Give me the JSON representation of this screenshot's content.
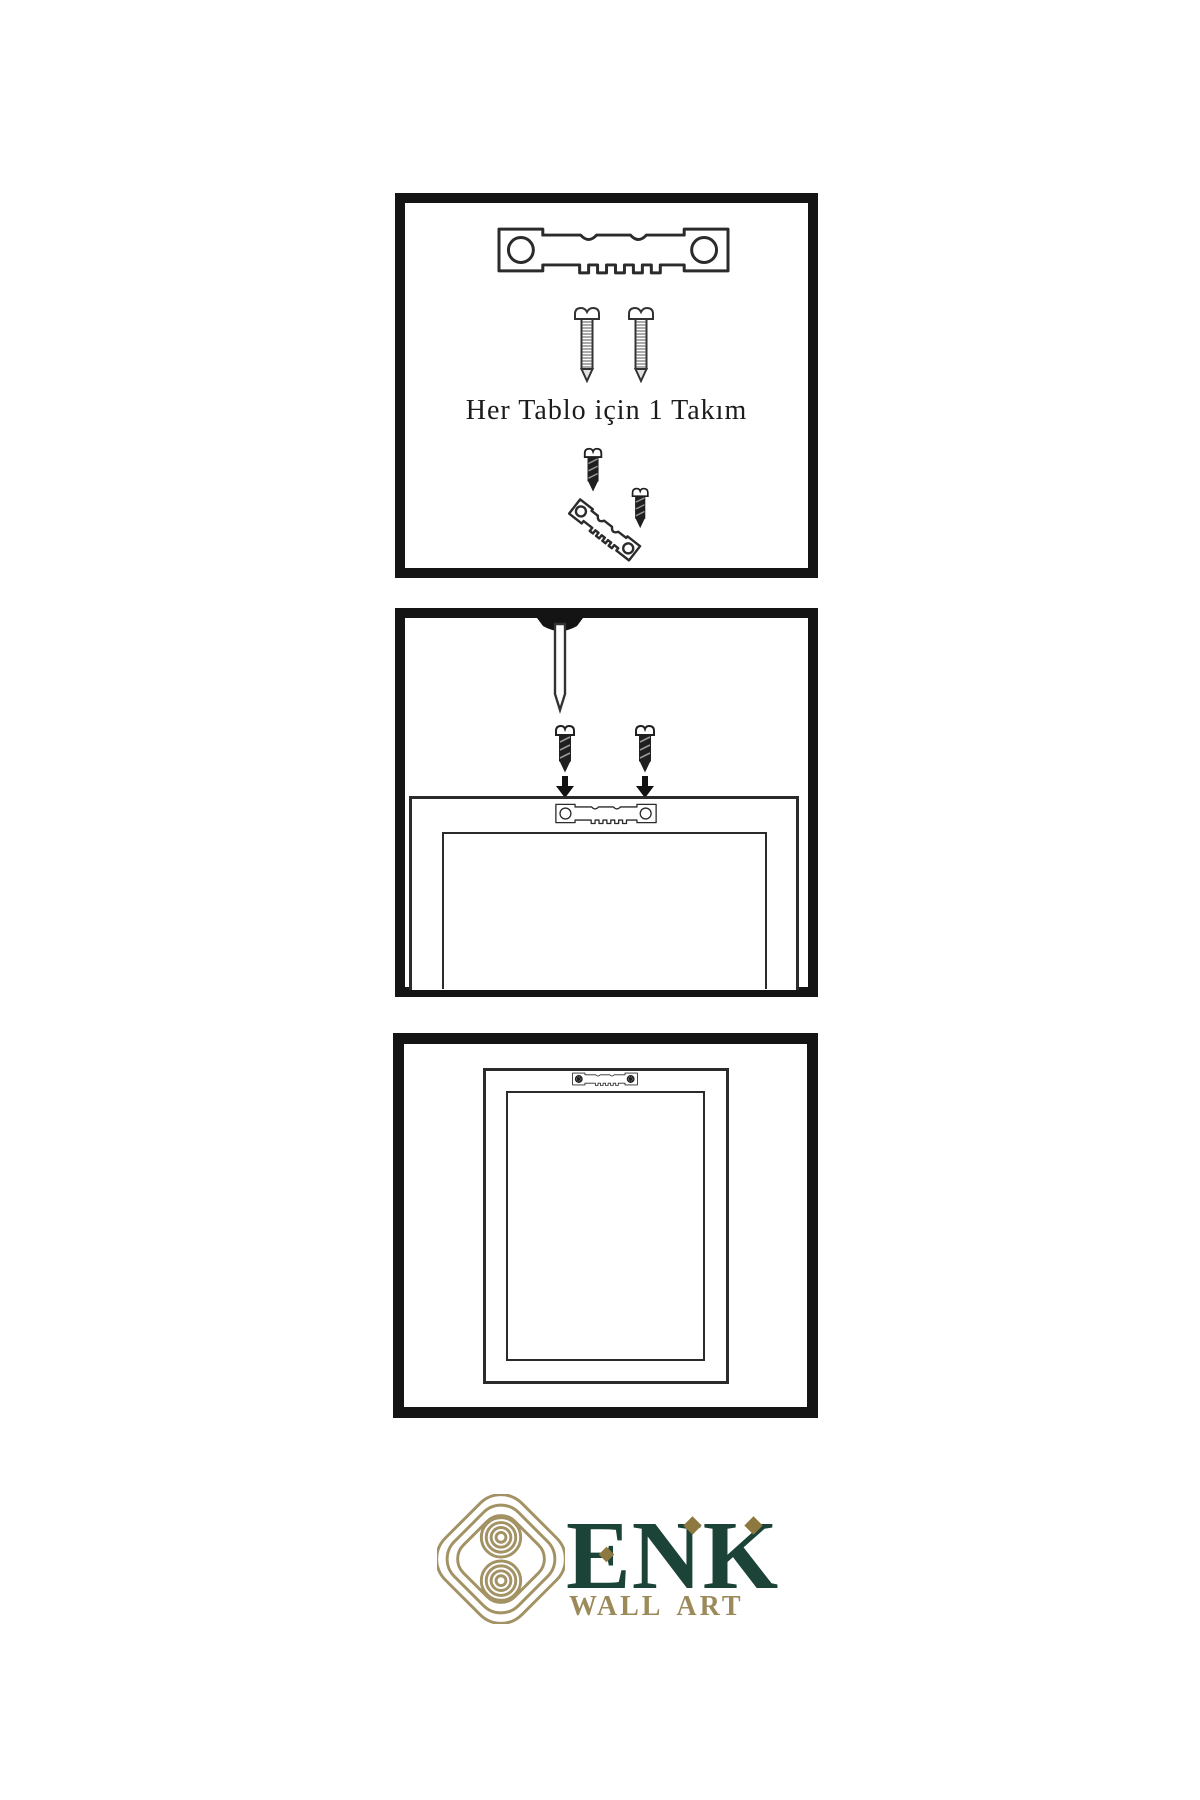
{
  "sheet": {
    "background": "#ffffff",
    "caption_step1": "Her Tablo için 1 Takım",
    "steps": [
      {
        "icons": [
          "sawtooth-hanger-icon",
          "screw-icon",
          "screw-icon",
          "dark-screw-icon",
          "angled-sawtooth-hanger-icon",
          "dark-screw-icon"
        ]
      },
      {
        "icons": [
          "nail-icon",
          "dark-screw-icon",
          "down-arrow-icon",
          "dark-screw-icon",
          "down-arrow-icon",
          "sawtooth-hanger-icon",
          "frame-back"
        ]
      },
      {
        "icons": [
          "frame-back",
          "mounted-sawtooth-hanger-icon"
        ]
      }
    ]
  },
  "logo": {
    "brand": "ENK",
    "subtitle": "WALL ART",
    "green": "#1b4337",
    "gold": "#9c8a5b",
    "knot_gold": "#a29264",
    "diamond_gold": "#8d7840"
  },
  "colors": {
    "panel_border": "#141414",
    "line_art": "#2b2b2b",
    "text": "#1c1c1c",
    "dark_hardware": "#1f1f1f"
  }
}
